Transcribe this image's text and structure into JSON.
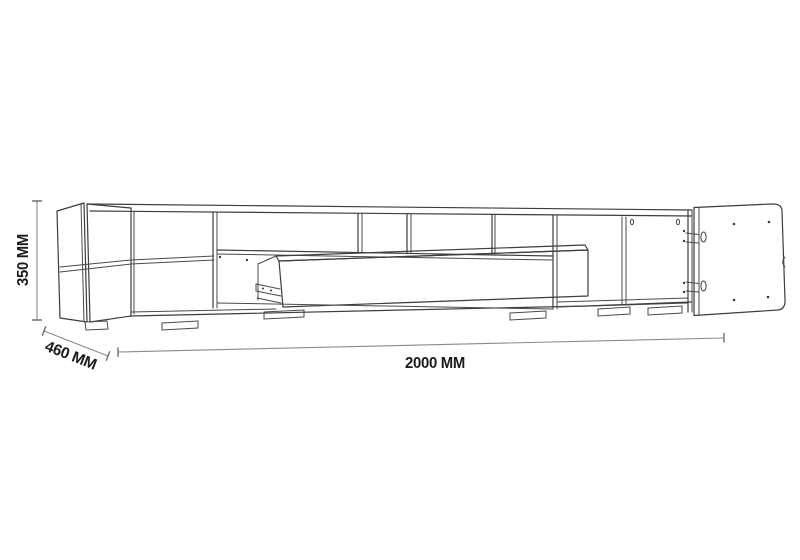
{
  "meta": {
    "title": "TV stand technical dimension drawing",
    "background_color": "#ffffff",
    "line_color": "#3d3d3d",
    "dimension_line_color": "#8a8a8a",
    "text_color": "#1b1b1b"
  },
  "drawing": {
    "subject": "Wall/floor TV stand with open shelf cubbies, tall left compartment with middle shelf, pulled-out center drawer with slide rail, right cabinet with door swung open, and small feet",
    "style": "black-and-white outline perspective drawing",
    "dimensions": {
      "height": {
        "label": "350 MM",
        "value": 350,
        "unit": "MM",
        "orientation": "vertical-left"
      },
      "depth": {
        "label": "460 MM",
        "value": 460,
        "unit": "MM",
        "orientation": "diagonal-bottom-left"
      },
      "width": {
        "label": "2000 MM",
        "value": 2000,
        "unit": "MM",
        "orientation": "horizontal-bottom"
      }
    }
  }
}
